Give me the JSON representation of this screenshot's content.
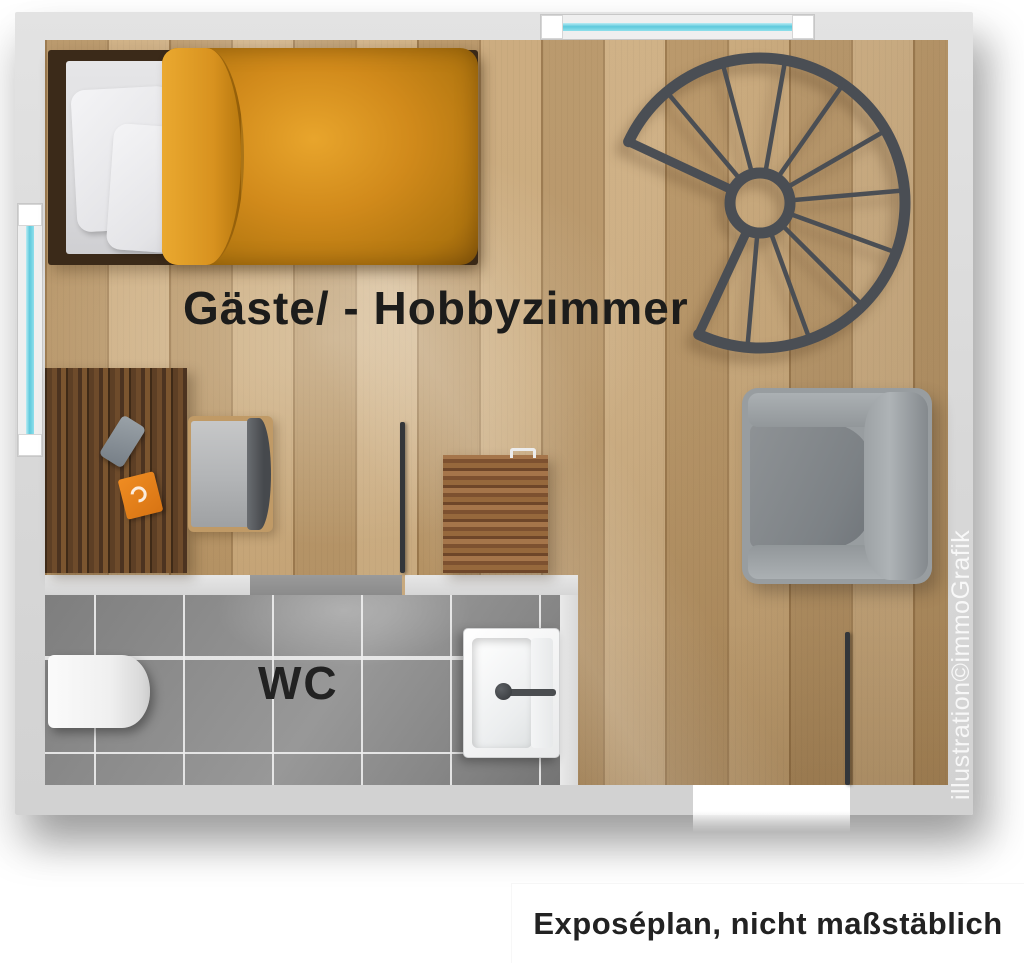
{
  "labels": {
    "room": "Gäste/ - Hobbyzimmer",
    "wc": "WC"
  },
  "watermark": "illustration©immoGrafik",
  "caption": "Exposéplan, nicht maßstäblich",
  "colors": {
    "wall": "#d8d8d8",
    "wood_floor": "#c7a678",
    "tile_floor": "#8f8f8f",
    "window_glass": "#5ec9dc",
    "staircase": "#4a4e54",
    "duvet": "#d18a1b",
    "armchair": "#989da0",
    "desk": "#5d3f25",
    "door_leaf": "#33363a",
    "sanitary_white": "#f5f5f5"
  },
  "furniture": [
    "bed",
    "desk",
    "desk-chair",
    "cabinet",
    "armchair",
    "spiral-staircase",
    "toilet",
    "sink"
  ]
}
